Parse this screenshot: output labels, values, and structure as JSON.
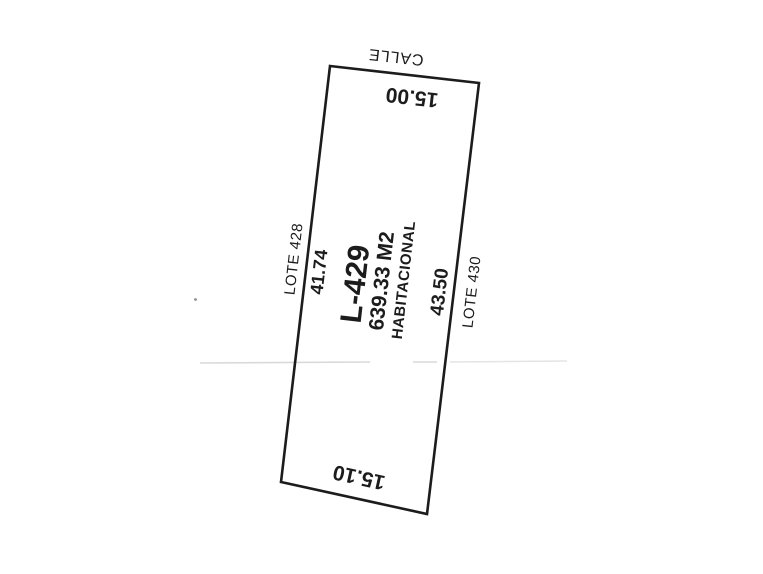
{
  "plan": {
    "street_label": "CALLE",
    "lot": {
      "id": "L-429",
      "area": "639.33 M2",
      "use": "HABITACIONAL"
    },
    "dimensions": {
      "front": "15.00",
      "rear": "15.10",
      "left_side": "41.74",
      "right_side": "43.50"
    },
    "adjacent_lots": {
      "left": "LOTE 428",
      "right": "LOTE 430"
    }
  },
  "colors": {
    "ink": "#1c1c1c",
    "paper": "#ffffff",
    "fold_line": "#d9d9d9",
    "fold_line_light": "#e4e4e4",
    "speck": "#8f8f8f"
  }
}
